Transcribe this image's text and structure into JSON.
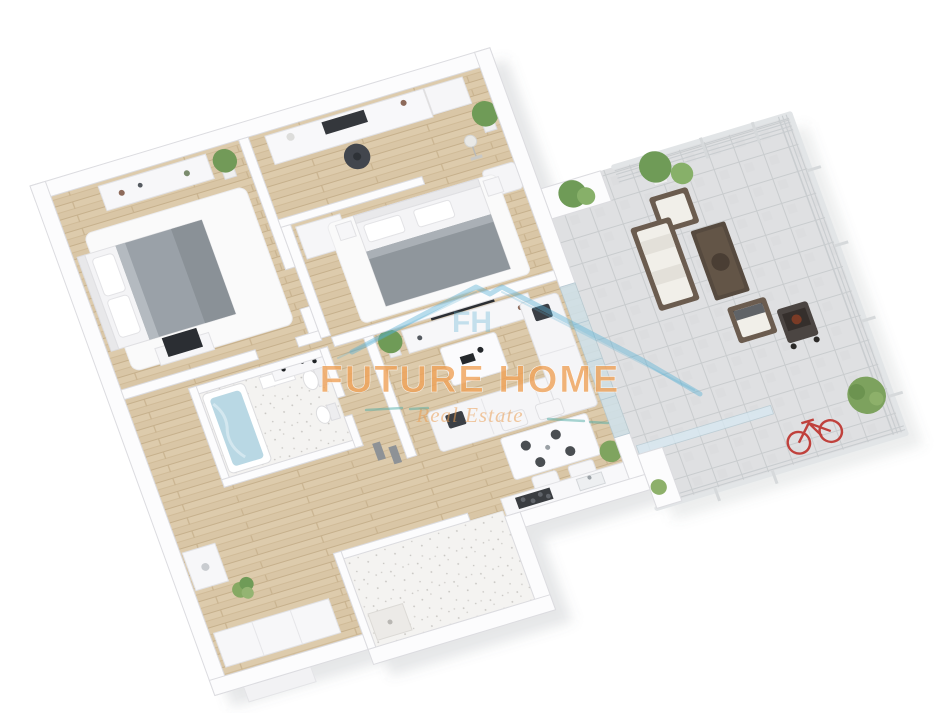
{
  "image": {
    "description": "3D axonometric render of an apartment floor plan with a large wrap-around terrace, white walls, light wood flooring and staged furniture",
    "background_color": "#ffffff",
    "view": "isometric top-down 3D floor plan, rotated"
  },
  "watermark": {
    "title": "FUTURE HOME",
    "subtitle": "Real Estate",
    "monogram": "FH",
    "logo": "house-roof-outline",
    "title_color": "#f0a258",
    "subtitle_color": "#eb9f55",
    "roof_color": "#58b0d3",
    "dash_color": "#53ada6"
  },
  "palette": {
    "wall": "#fcfcfd",
    "wall_edge": "#dcdce0",
    "wood_floor": "#d9c6a6",
    "wood_line": "#c6b08c",
    "bathroom_floor": "#f4f3f1",
    "terrace_tile": "#dfe0e2",
    "glass": "#cfe3ee",
    "bed_blanket_gray": "#9aa1a8",
    "sofa_white": "#f5f5f7",
    "dark_accent": "#2b2e33",
    "outdoor_wood": "#6b5c4f",
    "outdoor_cushion": "#f1efe9",
    "plant_green": "#6f9b57",
    "bath_water": "#b9d8e4",
    "bicycle_red": "#c0413c",
    "shadow": "rgba(100,105,115,0.16)"
  },
  "rooms": [
    {
      "id": "master-bedroom",
      "label": "Master bedroom",
      "floor": "wood",
      "furniture": [
        "double bed with gray blanket and white pillows",
        "white area rug",
        "dresser with decor along window wall",
        "TV on low stand",
        "three windows",
        "two glowing wall sconces",
        "potted plant"
      ]
    },
    {
      "id": "office-study",
      "label": "Office / study",
      "floor": "wood",
      "furniture": [
        "white desk with monitor and desk lamp",
        "dark office chair",
        "wall frames",
        "floor lamp",
        "white lounge chair",
        "tall potted plant",
        "two windows"
      ]
    },
    {
      "id": "bedroom-2",
      "label": "Second bedroom",
      "floor": "wood",
      "furniture": [
        "double bed with gray blanket",
        "two nightstands",
        "wardrobe",
        "white rug",
        "TV console with flat-screen TV facing living room"
      ]
    },
    {
      "id": "living-room",
      "label": "Living room",
      "floor": "wood",
      "furniture": [
        "white corner sofa with dark cushions",
        "white coffee table with black decor",
        "potted plant",
        "glass wall to terrace"
      ]
    },
    {
      "id": "dining-area",
      "label": "Dining area",
      "floor": "wood",
      "furniture": [
        "white dining table set for four",
        "four white chairs",
        "dark plates"
      ]
    },
    {
      "id": "kitchen",
      "label": "Kitchen",
      "floor": "wood",
      "furniture": [
        "counter along bottom wall",
        "dark cooktop with four burners",
        "sink with faucet",
        "corner plant"
      ]
    },
    {
      "id": "bathroom-1",
      "label": "Bathroom with tub",
      "floor": "speckled-tile",
      "furniture": [
        "bathtub filled with water",
        "toilet",
        "bidet",
        "towel stands by the door"
      ]
    },
    {
      "id": "bathroom-2",
      "label": "Second bathroom",
      "floor": "speckled-tile",
      "furniture": [
        "shower tray",
        "mostly hidden fixtures"
      ]
    },
    {
      "id": "hallway-entrance",
      "label": "Hallway / entrance",
      "floor": "wood",
      "furniture": [
        "white wardrobe cabinets",
        "washing machine cabinet",
        "console with black decor",
        "green plant",
        "entry step"
      ]
    },
    {
      "id": "terrace",
      "label": "Terrace / balcony",
      "floor": "gray-tile",
      "furniture": [
        "white cable railing",
        "planter wall with plants",
        "two potted trees",
        "outdoor sofa with wood frame and white cushions",
        "two outdoor armchairs",
        "dark wood coffee table with round tray",
        "barbecue grill",
        "green bush",
        "red bicycle behind glass screen"
      ]
    }
  ]
}
